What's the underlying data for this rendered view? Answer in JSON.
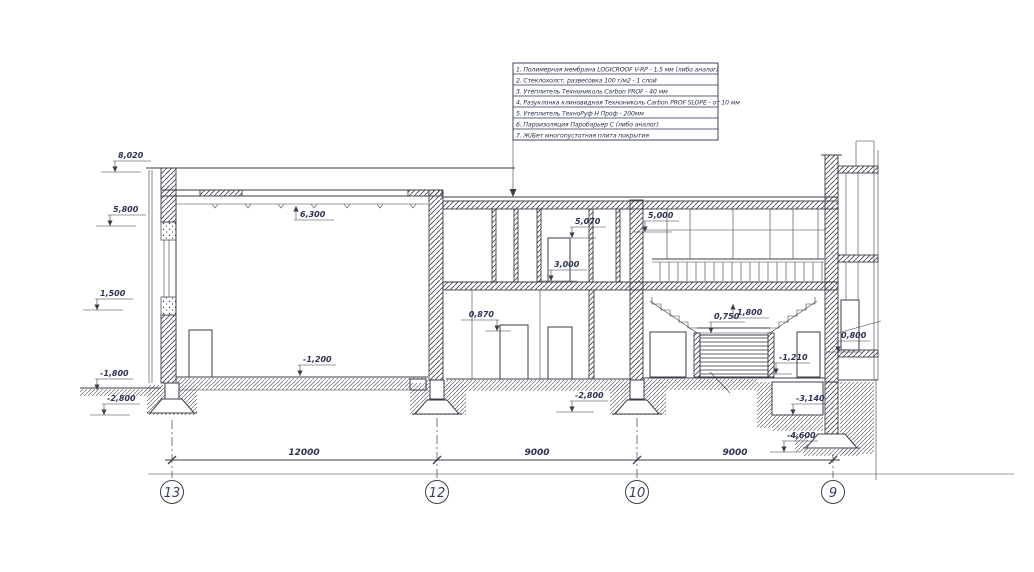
{
  "legend": {
    "items": [
      "1. Полимерная мембрана LOGICROOF V-RP - 1,5 мм (либо аналог)",
      "2. Стеклохолст, развесовка 100 г/м2 - 1 слой",
      "3. Утеплитель Технониколь Carbon PROF - 40 мм",
      "4. Разуклонка клиновидная Технониколь Carbon PROF SLOPE - от 10 мм",
      "5. Утеплитель ТехноРуф Н Проф - 200мм",
      "6. Пароизоляция Паробарьер С (либо аналог)",
      "7. Ж/Бет многопустотная плита покрытия"
    ]
  },
  "elevations": [
    "8,020",
    "5,800",
    "1,500",
    "-1,800",
    "-2,800",
    "6,300",
    "5,070",
    "5,000",
    "3,000",
    "0,870",
    "0,750",
    "1,800",
    "-1,200",
    "-2,800",
    "-1,210",
    "0,800",
    "-3,140",
    "-4,600"
  ],
  "dimensions": {
    "spans": [
      "12000",
      "9000",
      "9000"
    ]
  },
  "axes": {
    "bubbles": [
      "13",
      "12",
      "10",
      "9"
    ]
  },
  "colors": {
    "ink": "#3a3e48",
    "text_ink": "#2b3352",
    "axis_ink": "#33406b",
    "paper": "#ffffff"
  }
}
